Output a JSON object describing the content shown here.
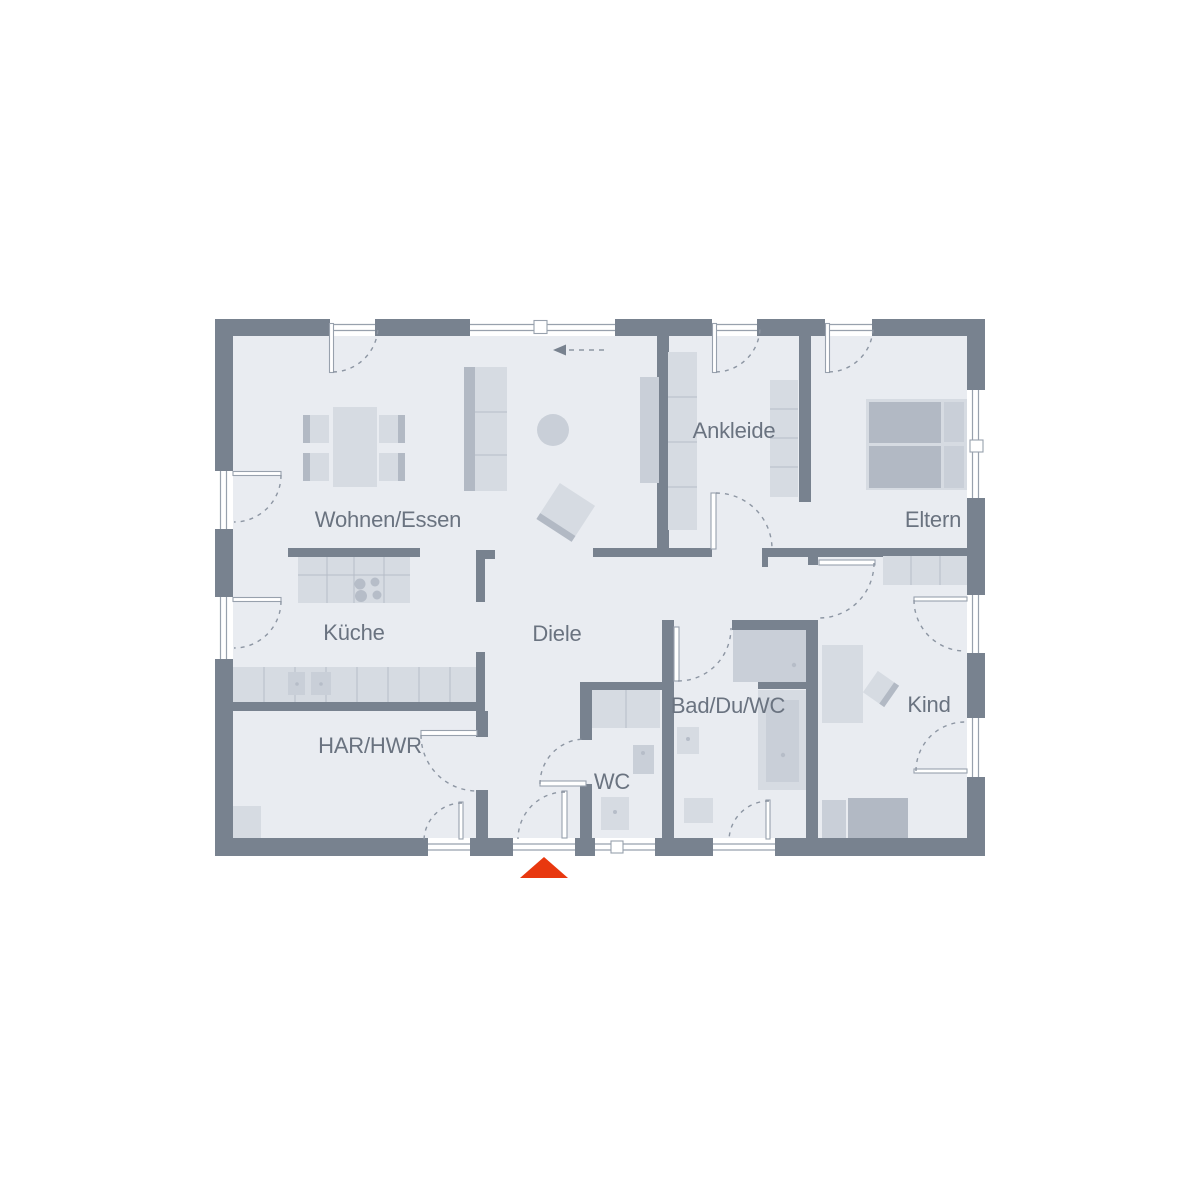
{
  "rooms": [
    {
      "id": "wohnen-essen",
      "label": "Wohnen/Essen"
    },
    {
      "id": "kueche",
      "label": "Küche"
    },
    {
      "id": "diele",
      "label": "Diele"
    },
    {
      "id": "har-hwr",
      "label": "HAR/HWR"
    },
    {
      "id": "wc",
      "label": "WC"
    },
    {
      "id": "bad-du-wc",
      "label": "Bad/Du/WC"
    },
    {
      "id": "ankleide",
      "label": "Ankleide"
    },
    {
      "id": "eltern",
      "label": "Eltern"
    },
    {
      "id": "kind",
      "label": "Kind"
    }
  ],
  "annotations": {
    "sliding_window_direction": "left",
    "entrance_marker": "red triangle pointing up at main entrance, bottom wall"
  },
  "colors": {
    "page": "#ffffff",
    "wall": "#78828f",
    "floor": "#e9ecf1",
    "furn": "#d6dbe2",
    "furn_mid": "#c9cfd8",
    "furn_dark": "#b2b9c4",
    "fline": "#b6bdc8",
    "frame": "#98a1ad",
    "arc": "#8d96a3",
    "text": "#6a7380",
    "accent": "#e8380f"
  }
}
